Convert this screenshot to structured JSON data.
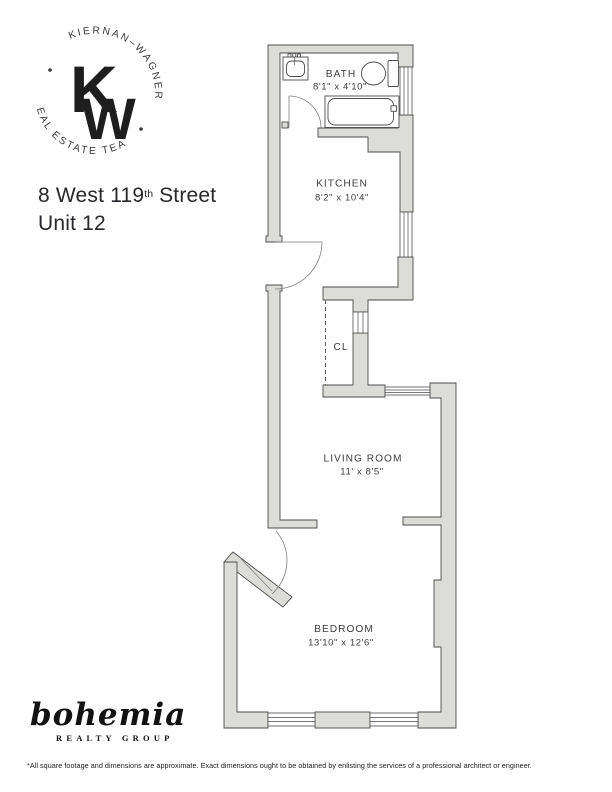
{
  "brand_logo": {
    "arc_top": "KIERNAN–WAGNER",
    "arc_bottom": "REAL ESTATE TEAM",
    "monogram_top": "K",
    "monogram_bottom": "W"
  },
  "listing": {
    "address_prefix": "8 West 119",
    "address_ordinal": "th",
    "address_suffix": " Street",
    "unit": "Unit 12"
  },
  "floor_plan": {
    "rooms": [
      {
        "name": "BATH",
        "dims": "8'1\" x 4'10\""
      },
      {
        "name": "KITCHEN",
        "dims": "8'2\" x 10'4\""
      },
      {
        "name": "CL",
        "dims": ""
      },
      {
        "name": "LIVING ROOM",
        "dims": "11' x 8'5\""
      },
      {
        "name": "BEDROOM",
        "dims": "13'10\" x 12'6\""
      }
    ]
  },
  "footer_logo": {
    "name": "bohemia",
    "subtitle": "REALTY GROUP"
  },
  "disclaimer": "*All square footage and dimensions are approximate. Exact dimensions ought to be obtained by enlisting the services of a professional architect or engineer.",
  "colors": {
    "wall_fill": "#dcdcd8",
    "outline": "#4c4c4c",
    "label_text": "#3d3d3d"
  }
}
